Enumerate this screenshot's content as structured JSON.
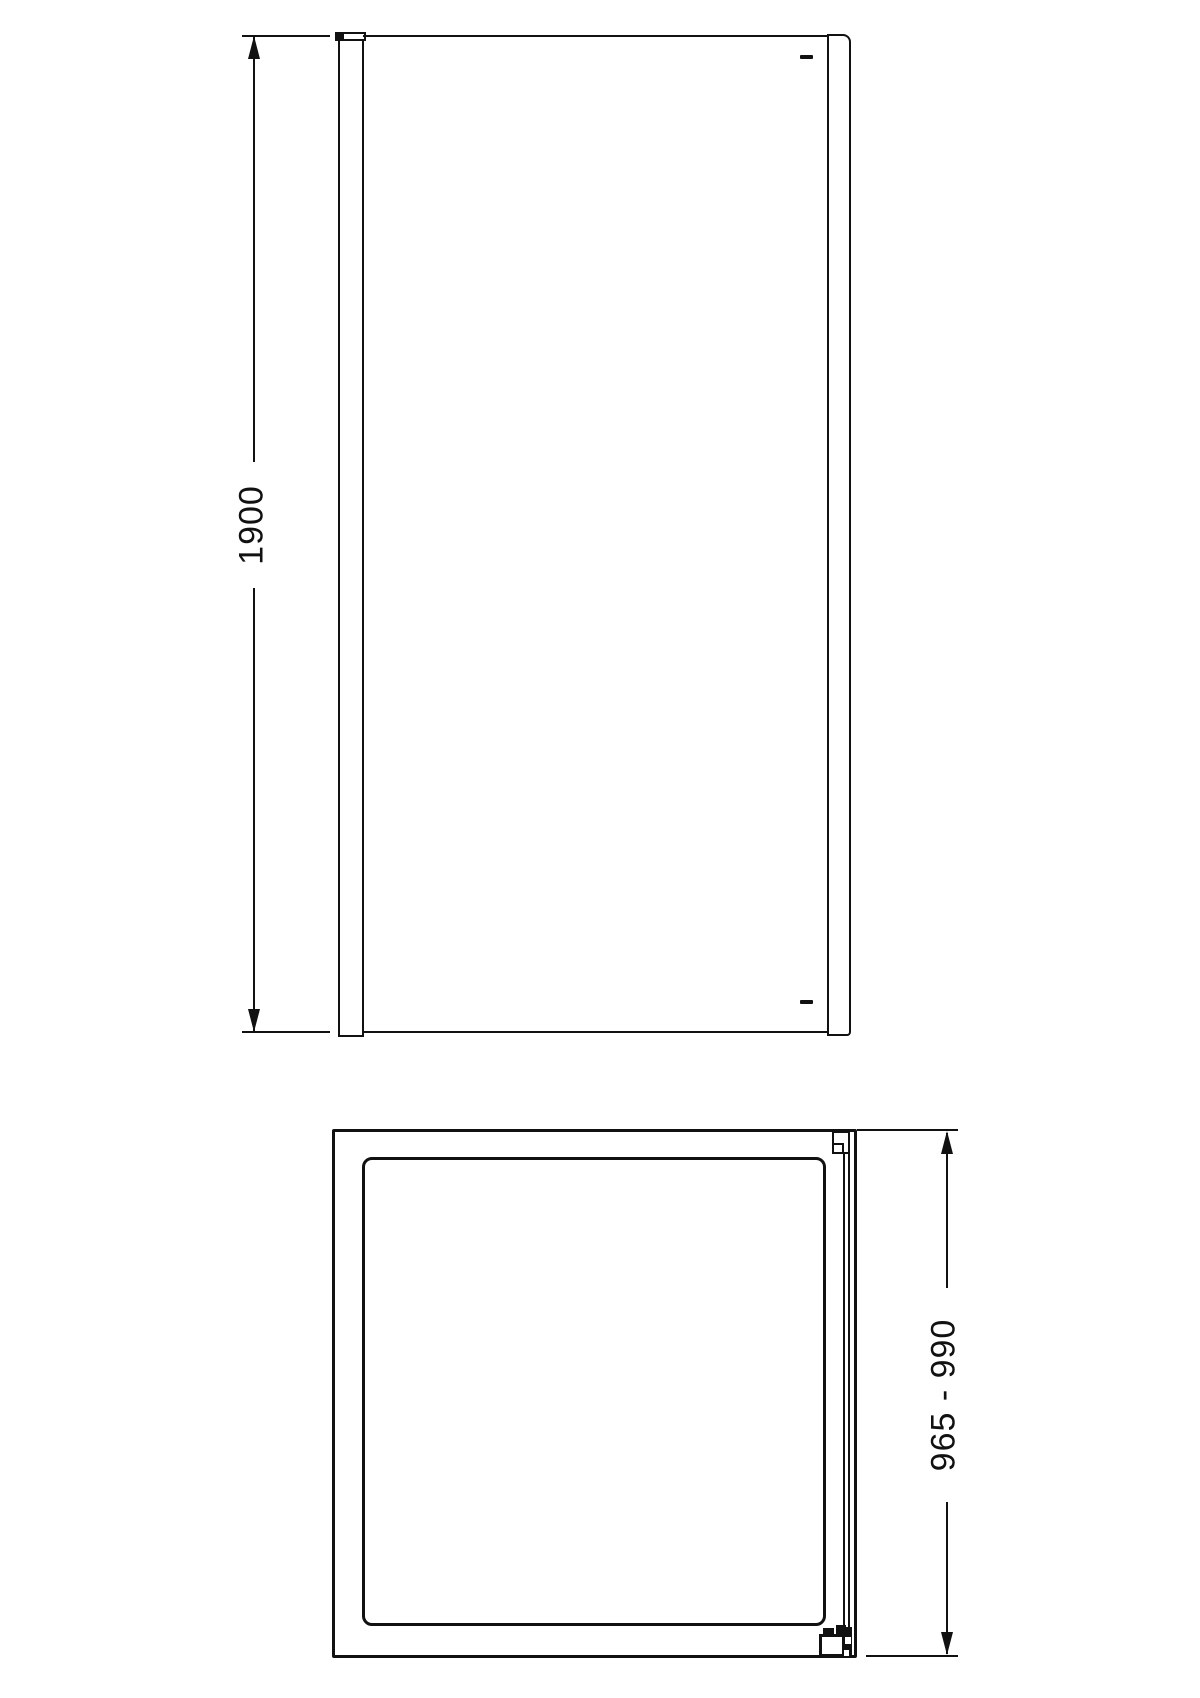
{
  "drawing": {
    "title": "shower-side-panel-technical-drawing",
    "line_color": "#111111",
    "background_color": "#ffffff",
    "front_view": {
      "name": "front-elevation-view",
      "height_label": "1900"
    },
    "plan_view": {
      "name": "plan-top-view",
      "depth_label": "965 - 990"
    }
  }
}
